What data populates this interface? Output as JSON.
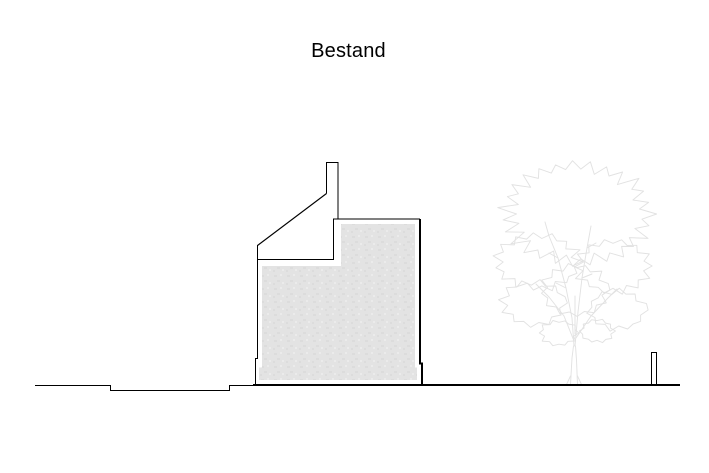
{
  "page": {
    "title": "Bestand"
  },
  "colors": {
    "background": "#ffffff",
    "outline": "#000000",
    "title_text": "#000000",
    "building_fill": "#e3e3e3",
    "building_fill_speckle_dark": "#dcdcdc",
    "building_fill_speckle_light": "#ebebeb",
    "tree_line": "#e2e2e2"
  }
}
